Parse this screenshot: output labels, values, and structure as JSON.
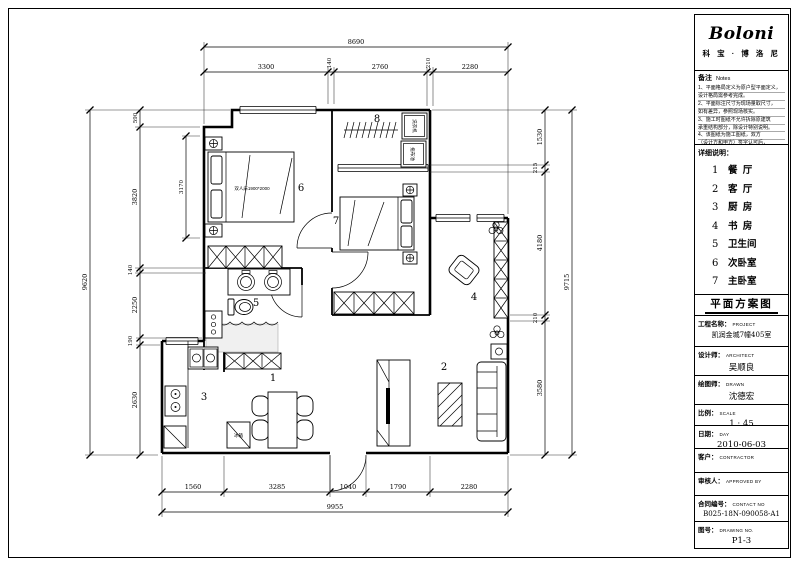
{
  "panel": {
    "logo": "Boloni",
    "logo_sub": "科 宝 · 博 洛 尼",
    "notes": {
      "title": "备注",
      "title_en": "Notes",
      "lines": [
        "1、平面格局定义为原户型平面定义，",
        "设计格局需参考完成。",
        "2、平面标注尺寸为现场量取尺寸，",
        "如有差异，参照现场核实。",
        "3、施工时图纸不允许拆除原建筑",
        "承重结构部分，除设计特别说明。",
        "4、该图纸为施工图纸，双方",
        "（设计方和甲方）签字认可后，",
        "方可施工。"
      ]
    },
    "legend": {
      "title": "详细说明：",
      "items": [
        {
          "num": "1",
          "name": "餐  厅"
        },
        {
          "num": "2",
          "name": "客  厅"
        },
        {
          "num": "3",
          "name": "厨  房"
        },
        {
          "num": "4",
          "name": "书  房"
        },
        {
          "num": "5",
          "name": "卫生间"
        },
        {
          "num": "6",
          "name": "次卧室"
        },
        {
          "num": "7",
          "name": "主卧室"
        },
        {
          "num": "8",
          "name": "南阳台"
        }
      ]
    },
    "titleblock": {
      "drawing_title": "平面方案图",
      "project_label": "工程名称：",
      "project_en": "PROJECT",
      "project_value": "凯润金城7幢405室",
      "architect_label": "设计师：",
      "architect_en": "ARCHITECT",
      "architect_value": "吴顺良",
      "drawn_label": "绘图师：",
      "drawn_en": "DRAWN",
      "drawn_value": "沈德宏",
      "scale_label": "比例：",
      "scale_en": "SCALE",
      "scale_value": "1 : 45",
      "date_label": "日期：",
      "date_en": "DAY",
      "date_value": "2010-06-03",
      "client_label": "客户：",
      "client_en": "CONTRACTOR",
      "client_value": "",
      "approved_label": "审核人：",
      "approved_en": "APPROVED BY",
      "approved_value": "",
      "contract_label": "合同编号：",
      "contract_en": "CONTACT NO",
      "contract_value": "B025-18N-090058-A1",
      "drawingno_label": "图号：",
      "drawingno_en": "DRAWING NO.",
      "drawingno_value": "P1-3"
    }
  },
  "plan": {
    "room_numbers": {
      "dining": "1",
      "living": "2",
      "kitchen": "3",
      "study": "4",
      "bath": "5",
      "bedroom2": "6",
      "bedroom1": "7",
      "balcony": "8"
    },
    "labels": {
      "bed": "双人床1900*2000",
      "fridge": "冰箱",
      "washer": "洗衣机",
      "mop": "拖布池"
    },
    "dims": {
      "top_total": "8690",
      "top": [
        "3300",
        "140",
        "2760",
        "210",
        "2280"
      ],
      "left_total": "9620",
      "left": [
        "590",
        "3820",
        "140",
        "2250",
        "190",
        "2630"
      ],
      "right_total": "9715",
      "right": [
        "1530",
        "215",
        "4180",
        "210",
        "3580"
      ],
      "bottom": [
        "1560",
        "3285",
        "1040",
        "1790",
        "2280"
      ],
      "bottom_total": "9955",
      "inner": "3170"
    }
  }
}
